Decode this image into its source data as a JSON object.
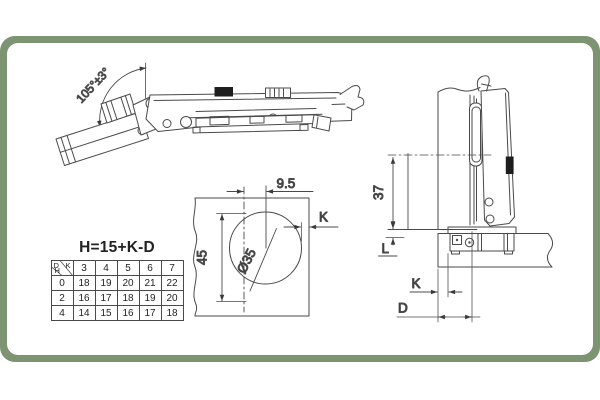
{
  "colors": {
    "frame_green": "#7d9473",
    "line": "#4a4a4a",
    "text": "#2a2a2a"
  },
  "open_view": {
    "angle_label": "105°±3°"
  },
  "drill_view": {
    "offset_dim": "9.5",
    "edge_distance_label": "K",
    "hole_spacing_dim": "45",
    "cup_diameter": "Ø35"
  },
  "side_view": {
    "height_dim": "37",
    "l_label": "L",
    "k_label": "K",
    "d_label": "D"
  },
  "table": {
    "formula": "H=15+K-D",
    "corner": {
      "row_var": "D",
      "col_var": "K",
      "cell_var": "H"
    },
    "col_headers": [
      "3",
      "4",
      "5",
      "6",
      "7"
    ],
    "rows": [
      {
        "label": "0",
        "values": [
          "18",
          "19",
          "20",
          "21",
          "22"
        ]
      },
      {
        "label": "2",
        "values": [
          "16",
          "17",
          "18",
          "19",
          "20"
        ]
      },
      {
        "label": "4",
        "values": [
          "14",
          "15",
          "16",
          "17",
          "18"
        ]
      }
    ]
  }
}
